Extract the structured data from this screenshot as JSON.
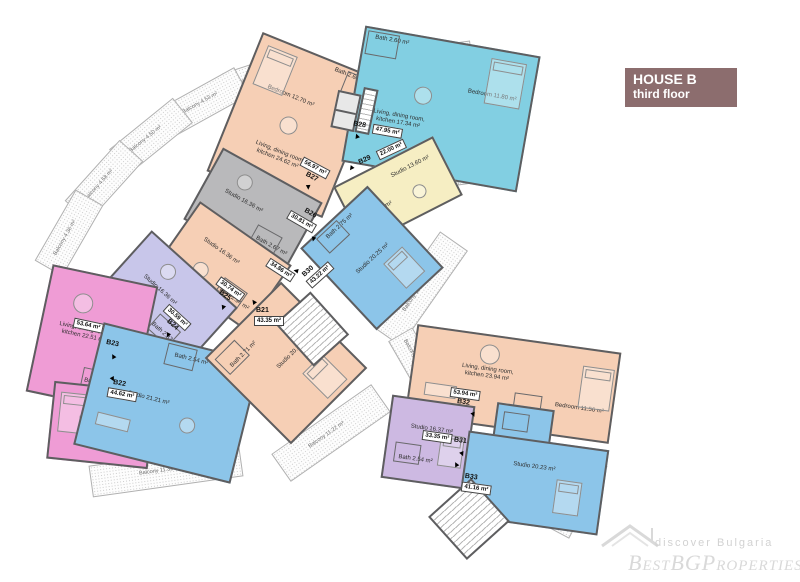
{
  "header": {
    "title": "HOUSE B",
    "subtitle": "third floor",
    "bg_color": "#8c6d6e"
  },
  "watermark": {
    "tagline": "discover Bulgaria",
    "brand": "BestBGProperties"
  },
  "units": [
    {
      "id": "B21",
      "total": "43.35 m²",
      "rooms": [
        "Studio 20.32 m²",
        "Bath 2.71 m²"
      ]
    },
    {
      "id": "B22",
      "total": "44.62 m²",
      "rooms": [
        "Studio 21.21 m²",
        "Bath 2.54 m²"
      ]
    },
    {
      "id": "B23",
      "total": "53.64 m²",
      "rooms": [
        "Living, dining room, kitchen 22.51 m²",
        "Bath 2.76 m²",
        "Bedroom 11.45 m²"
      ]
    },
    {
      "id": "B24",
      "total": "30.59 m²",
      "rooms": [
        "Studio 16.36 m²",
        "Bath 2.87 m²"
      ]
    },
    {
      "id": "B25",
      "total": "30.74 m²",
      "rooms": [
        "Studio 16.36 m²",
        "Bath 2.94 m²"
      ]
    },
    {
      "id": "B26",
      "total": "30.81 m²",
      "rooms": [
        "Studio 16.36 m²",
        "Bath 2.67 m²"
      ]
    },
    {
      "id": "B27",
      "total": "56.97 m²",
      "rooms": [
        "Bedroom 12.70 m²",
        "Living, dining room, kitchen 24.62 m²",
        "Bath 2.60 m²"
      ]
    },
    {
      "id": "B28",
      "total": "47.95 m²",
      "rooms": [
        "Bath 2.60 m²",
        "Bedroom 11.80 m²",
        "Living, dining room, kitchen 17.34 m²"
      ]
    },
    {
      "id": "B29",
      "total": "22.00 m²",
      "rooms": [
        "Studio 13.60 m²",
        "Bath 2.70 m²"
      ]
    },
    {
      "id": "B30",
      "total": "43.22 m²",
      "rooms": [
        "Bath 2.75 m²",
        "Studio 20.25 m²"
      ]
    },
    {
      "id": "B31",
      "total": "33.35 m²",
      "rooms": [
        "Studio 16.37 m²",
        "Bath 2.54 m²"
      ]
    },
    {
      "id": "B32",
      "total": "53.94 m²",
      "rooms": [
        "Living, dining room, kitchen 23.94 m²",
        "Bedroom 11.56 m²",
        "Bath 2.76 m²"
      ]
    },
    {
      "id": "B33",
      "total": "41.16 m²",
      "rooms": [
        "Studio 20.23 m²"
      ]
    }
  ],
  "extra_labels": {
    "corridor_area": "34.86 m²"
  },
  "balconies": [
    "Balcony 4.53 m²",
    "Balcony 4.53 m²",
    "Balcony 4.50 m²",
    "Balcony 4.58 m²",
    "Balcony 4.36 m²",
    "Balcony 5.59 m²",
    "Balcony 11.32 m²",
    "Balcony 11.22 m²",
    "Balcony 11.08 m²",
    "Balcony 4.50 m²",
    "Balcony 4.32 m²"
  ],
  "colors": {
    "peach": "#f6cfb5",
    "cyan": "#82cfe2",
    "blue": "#8cc5e9",
    "yellow": "#f6eec3",
    "gray": "#b9b9bb",
    "lavender": "#c8c6ea",
    "lilac": "#cdb9e2",
    "pink": "#ef9cd5",
    "wall": "#5e5e60",
    "header_bg": "#8c6d6e"
  }
}
